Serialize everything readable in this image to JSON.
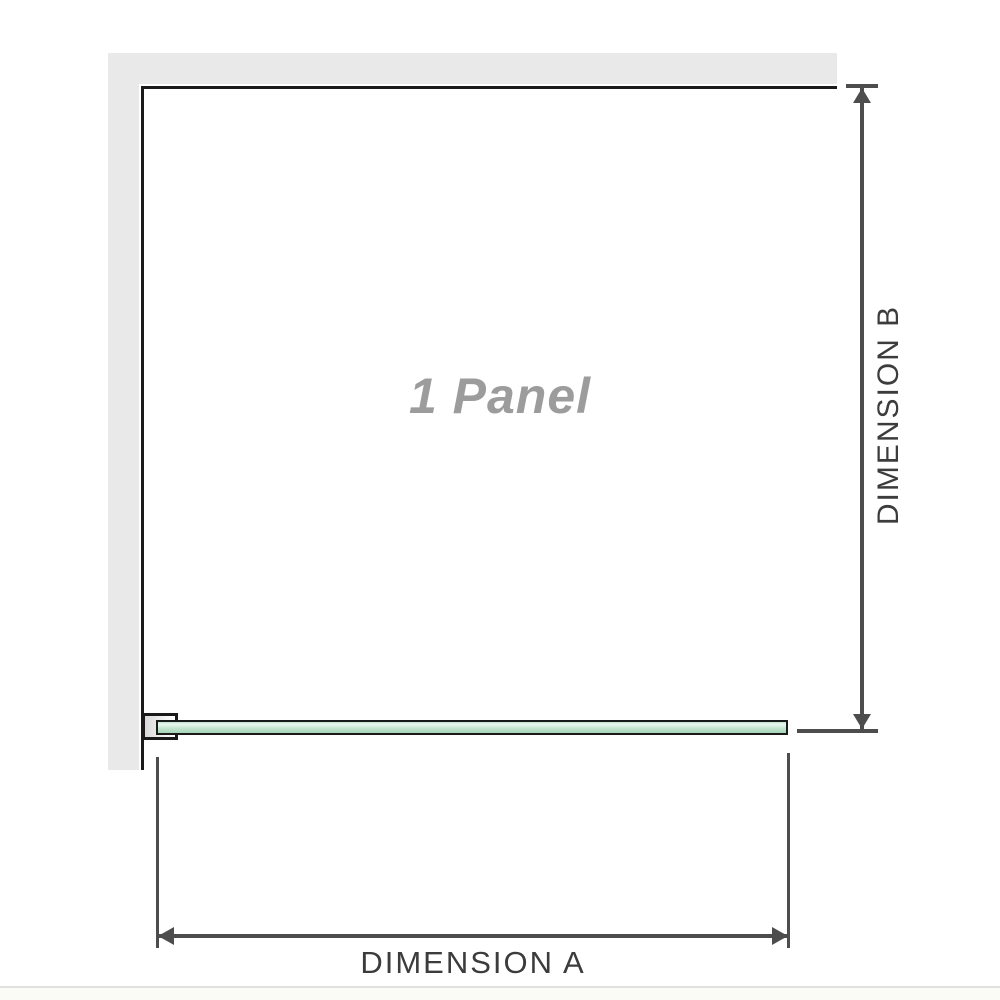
{
  "diagram": {
    "panel_label": "1 Panel",
    "dimension_a": {
      "label": "DIMENSION A"
    },
    "dimension_b": {
      "label": "DIMENSION B"
    }
  },
  "colors": {
    "wall-fill": "#e9e9e9",
    "wall-line": "#1a1a1a",
    "bracket-fill": "#d9d9d9",
    "glass-border": "#1a1a1a",
    "glass-fill-light": "#ecf7f0",
    "glass-fill-mid": "#c3e5cf",
    "glass-fill-deep": "#a4d5b8",
    "dim-line": "#4d4d4d",
    "dim-text": "#3c3c3c",
    "panel-label-text": "#9c9c9c",
    "page-edge-line": "#e0e0dc",
    "page-edge-fill": "#fafaf7"
  }
}
